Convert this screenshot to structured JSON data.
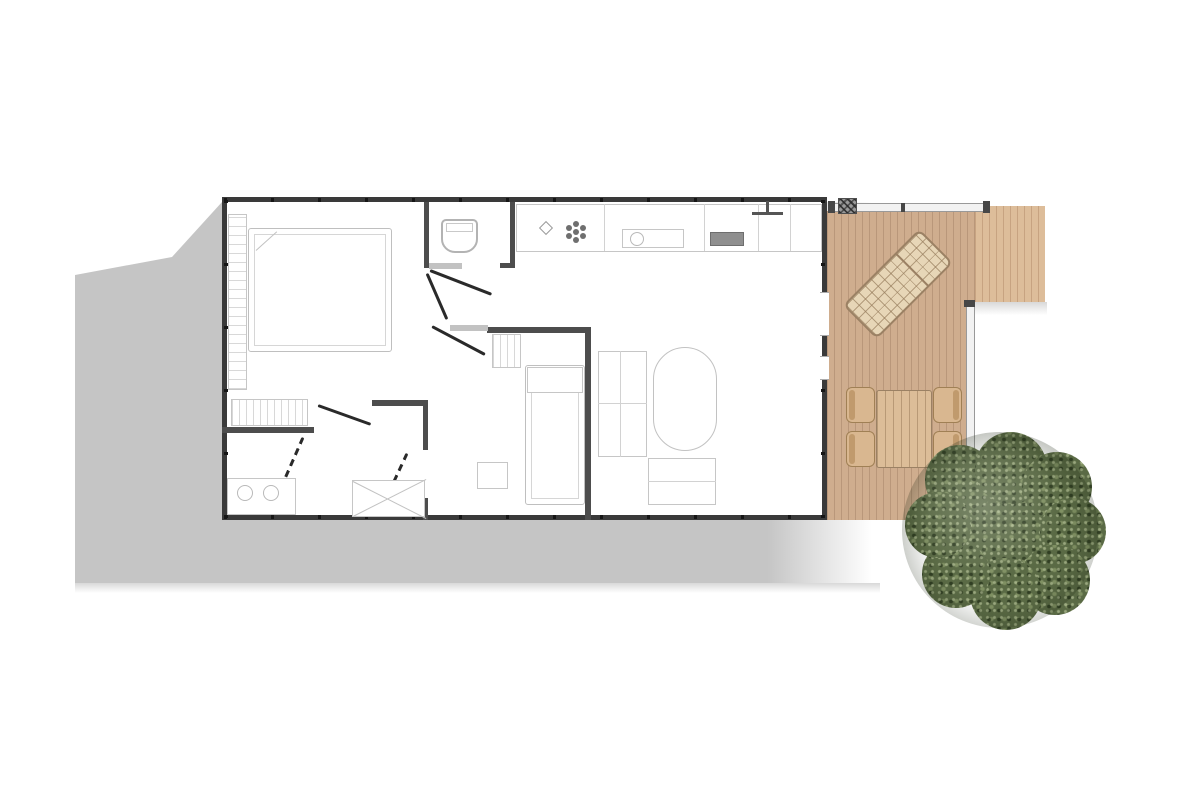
{
  "scene": {
    "width": 1200,
    "height": 800,
    "background": "#ffffff",
    "type": "floor-plan-top-view"
  },
  "palette": {
    "ground_shadow": "#c5c5c5",
    "outer_wall": "#3a3a3a",
    "inner_wall": "#4d4d4d",
    "furniture_line": "#c6c6c6",
    "deck_wood": "#cfad8e",
    "deck_wood_light": "#ddbd9a",
    "patio_furniture": "#dcbd98",
    "tree_green": "#5a6a45"
  },
  "items": [
    {
      "name": "ground-shadow",
      "cls": "shadow-poly",
      "x": 75,
      "y": 202,
      "w": 805,
      "h": 381,
      "clip": "0px 73px, 97px 55px, 147px 0px, 805px 0px, 805px 381px, 0px 381px",
      "interactable": false
    },
    {
      "name": "ground-shadow-fade",
      "cls": "fade-down",
      "x": 75,
      "y": 583,
      "w": 805,
      "h": 10,
      "interactable": false
    },
    {
      "name": "deck-main",
      "cls": "deck-planks",
      "x": 827,
      "y": 211,
      "w": 148,
      "h": 309,
      "interactable": false
    },
    {
      "name": "deck-extension",
      "cls": "deck-planks-light",
      "x": 975,
      "y": 206,
      "w": 70,
      "h": 96,
      "interactable": false
    },
    {
      "name": "deck-extension-shadow",
      "cls": "fade-down",
      "x": 975,
      "y": 302,
      "w": 72,
      "h": 13,
      "interactable": false
    },
    {
      "name": "deck-railing-top",
      "cls": "rail",
      "x": 828,
      "y": 203,
      "w": 161,
      "h": 9,
      "interactable": false
    },
    {
      "name": "railing-post",
      "cls": "post",
      "x": 828,
      "y": 201,
      "w": 7,
      "h": 12,
      "interactable": false
    },
    {
      "name": "railing-post",
      "cls": "post",
      "x": 901,
      "y": 203,
      "w": 4,
      "h": 9,
      "interactable": false
    },
    {
      "name": "railing-post",
      "cls": "post",
      "x": 983,
      "y": 201,
      "w": 7,
      "h": 12,
      "interactable": false
    },
    {
      "name": "deck-railing-right",
      "cls": "rail",
      "x": 966,
      "y": 302,
      "w": 9,
      "h": 218,
      "interactable": false
    },
    {
      "name": "railing-post",
      "cls": "post",
      "x": 964,
      "y": 300,
      "w": 11,
      "h": 7,
      "interactable": false
    },
    {
      "name": "railing-post",
      "cls": "post",
      "x": 964,
      "y": 513,
      "w": 11,
      "h": 7,
      "interactable": false
    },
    {
      "name": "deck-corner-grill",
      "cls": "hatch",
      "x": 838,
      "y": 198,
      "w": 19,
      "h": 16,
      "interactable": false
    },
    {
      "name": "sun-lounger",
      "cls": "lounger",
      "x": 874,
      "y": 230,
      "w": 48,
      "h": 108,
      "rot": 45,
      "interactable": false
    },
    {
      "name": "outdoor-table",
      "cls": "deck-table",
      "x": 876,
      "y": 390,
      "w": 56,
      "h": 78,
      "interactable": false
    },
    {
      "name": "outdoor-chair",
      "cls": "chair chair-left",
      "x": 846,
      "y": 387,
      "w": 29,
      "h": 36,
      "interactable": false
    },
    {
      "name": "outdoor-chair",
      "cls": "chair chair-left",
      "x": 846,
      "y": 431,
      "w": 29,
      "h": 36,
      "interactable": false
    },
    {
      "name": "outdoor-chair",
      "cls": "chair chair-right",
      "x": 933,
      "y": 387,
      "w": 29,
      "h": 36,
      "interactable": false
    },
    {
      "name": "outdoor-chair",
      "cls": "chair chair-right",
      "x": 933,
      "y": 431,
      "w": 29,
      "h": 36,
      "interactable": false
    },
    {
      "name": "building-outline",
      "cls": "building",
      "x": 222,
      "y": 197,
      "w": 605,
      "h": 323,
      "interactable": false
    },
    {
      "name": "wall-joint-ticks-top",
      "cls": "tickx",
      "x": 224,
      "y": 198,
      "w": 601,
      "h": 4,
      "interactable": false
    },
    {
      "name": "wall-joint-ticks-bottom",
      "cls": "tickx",
      "x": 224,
      "y": 515,
      "w": 601,
      "h": 4,
      "interactable": false
    },
    {
      "name": "wall-joint-ticks-left",
      "cls": "ticky",
      "x": 224,
      "y": 200,
      "w": 4,
      "h": 318,
      "interactable": false
    },
    {
      "name": "wall-joint-ticks-right",
      "cls": "ticky",
      "x": 821,
      "y": 200,
      "w": 4,
      "h": 318,
      "interactable": false
    },
    {
      "name": "patio-door-opening",
      "cls": "window-gap",
      "x": 820,
      "y": 292,
      "w": 9,
      "h": 44,
      "interactable": false
    },
    {
      "name": "patio-window-opening",
      "cls": "window-gap",
      "x": 820,
      "y": 356,
      "w": 9,
      "h": 24,
      "interactable": false
    },
    {
      "name": "wall-wc-west",
      "cls": "wall",
      "x": 424,
      "y": 202,
      "w": 5,
      "h": 66,
      "interactable": false
    },
    {
      "name": "wall-wc-east",
      "cls": "wall",
      "x": 510,
      "y": 202,
      "w": 5,
      "h": 66,
      "interactable": false
    },
    {
      "name": "wall-wc-east-foot",
      "cls": "wall",
      "x": 500,
      "y": 263,
      "w": 12,
      "h": 5,
      "interactable": false
    },
    {
      "name": "wall-bedroom-south-left",
      "cls": "wall",
      "x": 222,
      "y": 427,
      "w": 92,
      "h": 6,
      "interactable": false
    },
    {
      "name": "wall-bedroom-south-right",
      "cls": "wall",
      "x": 372,
      "y": 400,
      "w": 54,
      "h": 6,
      "interactable": false
    },
    {
      "name": "wall-bathroom-east-upper",
      "cls": "wall",
      "x": 423,
      "y": 400,
      "w": 5,
      "h": 50,
      "interactable": false
    },
    {
      "name": "wall-bathroom-east-lower",
      "cls": "wall",
      "x": 423,
      "y": 498,
      "w": 5,
      "h": 22,
      "interactable": false
    },
    {
      "name": "wall-bedroom2-north",
      "cls": "wall",
      "x": 487,
      "y": 327,
      "w": 104,
      "h": 6,
      "interactable": false
    },
    {
      "name": "wall-bedroom2-east",
      "cls": "wall",
      "x": 585,
      "y": 327,
      "w": 6,
      "h": 193,
      "interactable": false
    },
    {
      "name": "door-sill",
      "cls": "sill",
      "x": 429,
      "y": 263,
      "w": 33,
      "h": 6,
      "interactable": false
    },
    {
      "name": "door-sill",
      "cls": "sill",
      "x": 450,
      "y": 325,
      "w": 38,
      "h": 6,
      "interactable": false
    },
    {
      "name": "door-swing-wc",
      "cls": "door-line",
      "x": 430,
      "y": 269,
      "w": 66,
      "rot": 21.2,
      "interactable": false
    },
    {
      "name": "door-swing-hall",
      "cls": "door-line",
      "x": 427,
      "y": 272,
      "w": 50,
      "rot": 66.5,
      "interactable": false
    },
    {
      "name": "door-swing-bedroom2",
      "cls": "door-line",
      "x": 432,
      "y": 325,
      "w": 60,
      "rot": 27.9,
      "interactable": false
    },
    {
      "name": "door-swing-bedroom1",
      "cls": "door-line",
      "x": 318,
      "y": 404,
      "w": 56,
      "rot": 19.7,
      "interactable": false
    },
    {
      "name": "door-swing-bathroom",
      "cls": "door-line door-dashed",
      "x": 303,
      "y": 436,
      "w": 55,
      "rot": 113.7,
      "interactable": false
    },
    {
      "name": "door-swing-bathroom2",
      "cls": "door-line door-dashed",
      "x": 407,
      "y": 452,
      "w": 50,
      "rot": 115,
      "interactable": false
    },
    {
      "name": "double-bed",
      "cls": "bed",
      "x": 248,
      "y": 228,
      "w": 144,
      "h": 124,
      "interactable": false
    },
    {
      "name": "pillow-line",
      "cls": "lite-line",
      "x": 256,
      "y": 250,
      "w": 28,
      "rot": -42,
      "interactable": false
    },
    {
      "name": "wardrobe-shelves",
      "cls": "stripes-h",
      "x": 228,
      "y": 214,
      "w": 19,
      "h": 176,
      "interactable": false
    },
    {
      "name": "sliding-wardrobe",
      "cls": "stripes-v",
      "x": 231,
      "y": 399,
      "w": 77,
      "h": 27,
      "interactable": false
    },
    {
      "name": "toilet",
      "cls": "toilet",
      "x": 441,
      "y": 219,
      "w": 37,
      "h": 34,
      "interactable": false
    },
    {
      "name": "kitchen-counter",
      "cls": "outline",
      "x": 516,
      "y": 204,
      "w": 306,
      "h": 48,
      "interactable": false
    },
    {
      "name": "counter-divider",
      "cls": "vlite",
      "x": 604,
      "y": 204,
      "h": 47,
      "interactable": false
    },
    {
      "name": "counter-divider",
      "cls": "vlite",
      "x": 704,
      "y": 204,
      "h": 47,
      "interactable": false
    },
    {
      "name": "counter-divider",
      "cls": "vlite",
      "x": 758,
      "y": 204,
      "h": 47,
      "interactable": false
    },
    {
      "name": "counter-divider",
      "cls": "vlite",
      "x": 790,
      "y": 204,
      "h": 47,
      "interactable": false
    },
    {
      "name": "kitchen-sink",
      "cls": "outline",
      "x": 622,
      "y": 229,
      "w": 62,
      "h": 19,
      "interactable": false
    },
    {
      "name": "sink-basin",
      "cls": "circle-o",
      "x": 630,
      "y": 232,
      "w": 14,
      "h": 14,
      "interactable": false
    },
    {
      "name": "cooktop",
      "cls": "dark-rect",
      "x": 710,
      "y": 232,
      "w": 34,
      "h": 14,
      "interactable": false
    },
    {
      "name": "vent-fan-icon",
      "cls": "flower",
      "x": 564,
      "y": 220,
      "w": 24,
      "h": 24,
      "interactable": false
    },
    {
      "name": "light-fixture-icon",
      "cls": "diamond",
      "x": 541,
      "y": 223,
      "w": 10,
      "h": 10,
      "rot": 45,
      "interactable": false
    },
    {
      "name": "entry-marker-post",
      "cls": "mark",
      "x": 766,
      "y": 201,
      "w": 3,
      "h": 13,
      "interactable": false
    },
    {
      "name": "entry-marker-bar",
      "cls": "mark",
      "x": 752,
      "y": 212,
      "w": 31,
      "h": 3,
      "interactable": false
    },
    {
      "name": "dinette-bench-left",
      "cls": "outline",
      "x": 598,
      "y": 351,
      "w": 49,
      "h": 106,
      "interactable": false
    },
    {
      "name": "bench-divider",
      "cls": "hlite",
      "x": 598,
      "y": 403,
      "w": 49,
      "interactable": false
    },
    {
      "name": "bench-divider",
      "cls": "vlite",
      "x": 620,
      "y": 351,
      "h": 106,
      "interactable": false
    },
    {
      "name": "dinette-table",
      "cls": "oval",
      "x": 653,
      "y": 347,
      "w": 64,
      "h": 104,
      "interactable": false
    },
    {
      "name": "dinette-bench-bottom",
      "cls": "outline",
      "x": 648,
      "y": 458,
      "w": 68,
      "h": 47,
      "interactable": false
    },
    {
      "name": "bench-divider",
      "cls": "hlite",
      "x": 648,
      "y": 481,
      "w": 68,
      "interactable": false
    },
    {
      "name": "single-bed",
      "cls": "bed",
      "x": 525,
      "y": 365,
      "w": 60,
      "h": 140,
      "interactable": false
    },
    {
      "name": "bed-pillow",
      "cls": "outline",
      "x": 527,
      "y": 367,
      "w": 56,
      "h": 26,
      "interactable": false
    },
    {
      "name": "shelf-unit",
      "cls": "stripes-v",
      "x": 492,
      "y": 334,
      "w": 29,
      "h": 34,
      "interactable": false
    },
    {
      "name": "desk",
      "cls": "outline",
      "x": 477,
      "y": 462,
      "w": 31,
      "h": 27,
      "interactable": false
    },
    {
      "name": "shower",
      "cls": "outline",
      "x": 352,
      "y": 480,
      "w": 73,
      "h": 37,
      "interactable": false
    },
    {
      "name": "shower-cross-line",
      "cls": "lite-line",
      "x": 353,
      "y": 481,
      "w": 82,
      "rot": 26.9,
      "interactable": false
    },
    {
      "name": "shower-cross-line",
      "cls": "lite-line",
      "x": 353,
      "y": 516,
      "w": 82,
      "rot": -26.9,
      "interactable": false
    },
    {
      "name": "vanity",
      "cls": "outline",
      "x": 227,
      "y": 478,
      "w": 69,
      "h": 37,
      "interactable": false
    },
    {
      "name": "vanity-basin",
      "cls": "circle-o",
      "x": 237,
      "y": 485,
      "w": 16,
      "h": 16,
      "interactable": false
    },
    {
      "name": "vanity-basin",
      "cls": "circle-o",
      "x": 263,
      "y": 485,
      "w": 16,
      "h": 16,
      "interactable": false
    },
    {
      "name": "tree-foliage",
      "cls": "tree-tex",
      "x": 925,
      "y": 452,
      "w": 150,
      "h": 150,
      "interactable": false
    },
    {
      "name": "tree-foliage-lobe",
      "cls": "tree-tex",
      "x": 925,
      "y": 445,
      "w": 70,
      "h": 70,
      "interactable": false
    },
    {
      "name": "tree-foliage-lobe",
      "cls": "tree-tex",
      "x": 975,
      "y": 432,
      "w": 72,
      "h": 72,
      "interactable": false
    },
    {
      "name": "tree-foliage-lobe",
      "cls": "tree-tex",
      "x": 1022,
      "y": 452,
      "w": 70,
      "h": 70,
      "interactable": false
    },
    {
      "name": "tree-foliage-lobe",
      "cls": "tree-tex",
      "x": 1040,
      "y": 498,
      "w": 66,
      "h": 66,
      "interactable": false
    },
    {
      "name": "tree-foliage-lobe",
      "cls": "tree-tex",
      "x": 1020,
      "y": 545,
      "w": 70,
      "h": 70,
      "interactable": false
    },
    {
      "name": "tree-foliage-lobe",
      "cls": "tree-tex",
      "x": 970,
      "y": 558,
      "w": 72,
      "h": 72,
      "interactable": false
    },
    {
      "name": "tree-foliage-lobe",
      "cls": "tree-tex",
      "x": 922,
      "y": 540,
      "w": 68,
      "h": 68,
      "interactable": false
    },
    {
      "name": "tree-foliage-lobe",
      "cls": "tree-tex",
      "x": 905,
      "y": 492,
      "w": 66,
      "h": 66,
      "interactable": false
    },
    {
      "name": "tree-shading",
      "cls": "tree-shade",
      "x": 902,
      "y": 432,
      "w": 196,
      "h": 196,
      "interactable": false
    }
  ]
}
